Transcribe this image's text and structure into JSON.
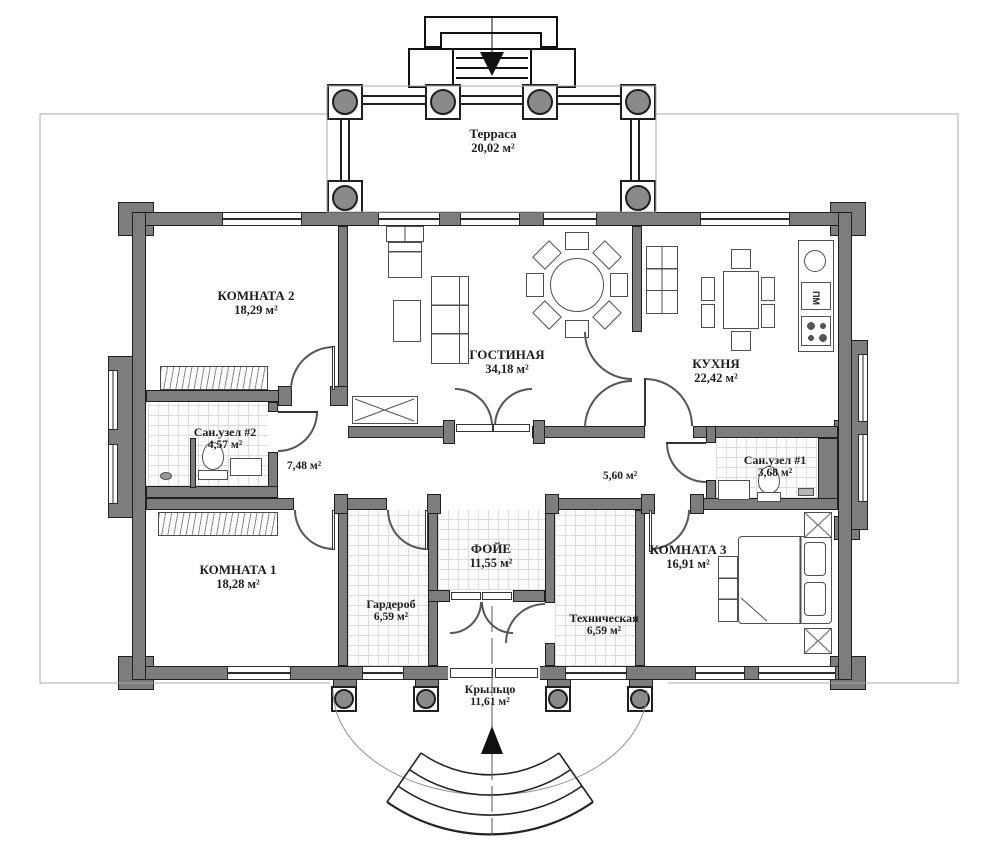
{
  "plan": {
    "colors": {
      "wall": "#7d7d7d",
      "line": "#1f1f1f",
      "text": "#1c1c1c",
      "tile_grid": "#dcdcdc"
    },
    "rooms": [
      {
        "key": "terrace",
        "name": "Терраса",
        "area": "20,02 м²"
      },
      {
        "key": "room2",
        "name": "КОМНАТА 2",
        "area": "18,29 м²"
      },
      {
        "key": "living",
        "name": "ГОСТИНАЯ",
        "area": "34,18 м²"
      },
      {
        "key": "kitchen",
        "name": "КУХНЯ",
        "area": "22,42 м²"
      },
      {
        "key": "bath2",
        "name": "Сан.узел #2",
        "area": "4,57 м²"
      },
      {
        "key": "hall_left",
        "name": "",
        "area": "7,48 м²"
      },
      {
        "key": "hall_right",
        "name": "",
        "area": "5,60 м²"
      },
      {
        "key": "bath1",
        "name": "Сан.узел #1",
        "area": "3,68 м²"
      },
      {
        "key": "room1",
        "name": "КОМНАТА 1",
        "area": "18,28 м²"
      },
      {
        "key": "wardrobe",
        "name": "Гардероб",
        "area": "6,59 м²"
      },
      {
        "key": "foyer",
        "name": "ФОЙЕ",
        "area": "11,55 м²"
      },
      {
        "key": "tech",
        "name": "Техническая",
        "area": "6,59 м²"
      },
      {
        "key": "room3",
        "name": "КОМНАТА 3",
        "area": "16,91 м²"
      },
      {
        "key": "porch",
        "name": "Крыльцо",
        "area": "11,61 м²"
      }
    ],
    "labels": {
      "dishwasher": "ПМ"
    }
  }
}
